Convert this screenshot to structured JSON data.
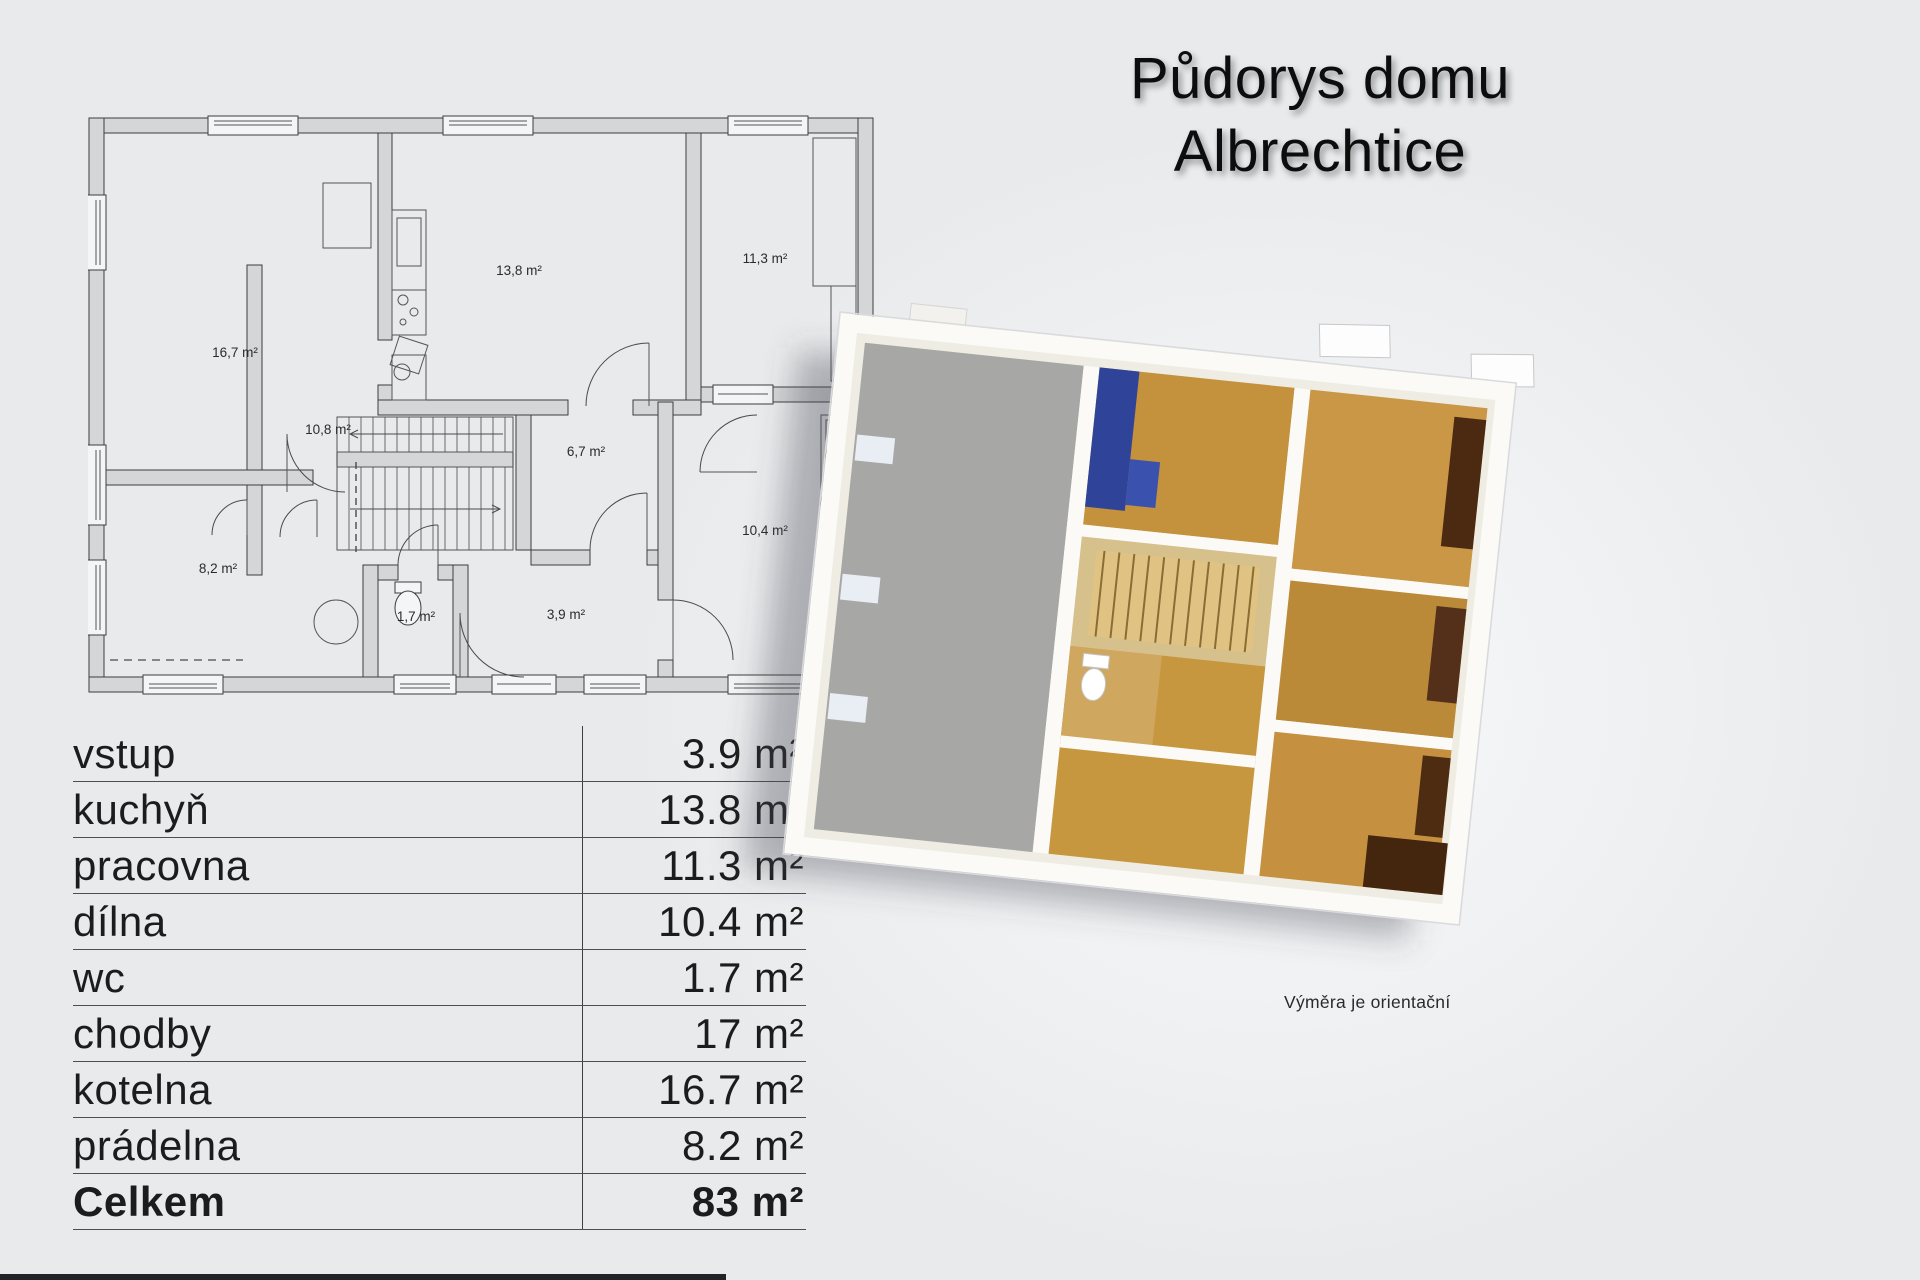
{
  "page": {
    "title_line1": "Půdorys domu",
    "title_line2": "Albrechtice",
    "footnote": "Výměra je orientační"
  },
  "plan2d": {
    "labels": [
      {
        "name": "kotelna",
        "text": "16,7 m²"
      },
      {
        "name": "kuchyn",
        "text": "13,8 m²"
      },
      {
        "name": "pracovna",
        "text": "11,3 m²"
      },
      {
        "name": "chodba-schodiste",
        "text": "10,8 m²"
      },
      {
        "name": "chodba",
        "text": "6,7 m²"
      },
      {
        "name": "dilna",
        "text": "10,4 m²"
      },
      {
        "name": "pradelna",
        "text": "8,2 m²"
      },
      {
        "name": "wc",
        "text": "1,7 m²"
      },
      {
        "name": "vstup",
        "text": "3,9 m²"
      }
    ]
  },
  "area_table": {
    "rows": [
      {
        "label": "vstup",
        "value": "3.9 m²"
      },
      {
        "label": "kuchyň",
        "value": "13.8 m²"
      },
      {
        "label": "pracovna",
        "value": "11.3 m²"
      },
      {
        "label": "dílna",
        "value": "10.4 m²"
      },
      {
        "label": "wc",
        "value": "1.7 m²"
      },
      {
        "label": "chodby",
        "value": "17 m²"
      },
      {
        "label": "kotelna",
        "value": "16.7 m²"
      },
      {
        "label": "prádelna",
        "value": "8.2 m²"
      }
    ],
    "total_row": {
      "label": "Celkem",
      "value": "83 m²"
    }
  },
  "colors": {
    "background": "#e8eaec",
    "wall_fill": "#d5d6d8",
    "line": "#3d3d3d",
    "text": "#1c1c1c",
    "wood_floor": "#c4913c",
    "concrete_floor": "#a7a7a5",
    "kitchen_blue": "#2f4398",
    "furniture_brown": "#4c2a11",
    "white_wall": "#fbfaf6"
  }
}
